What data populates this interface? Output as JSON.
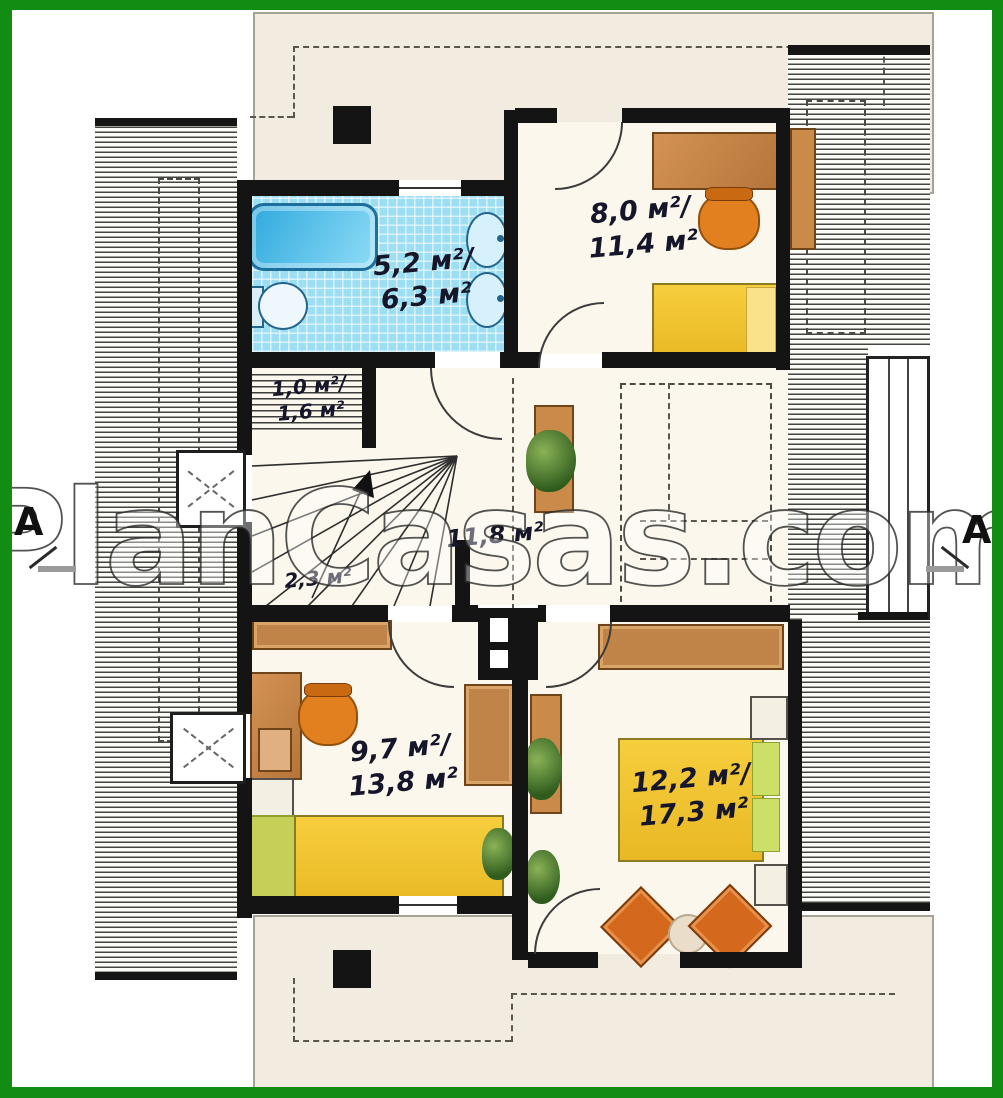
{
  "watermark": "PlanCasas.com",
  "markers": {
    "left": "A",
    "right": "A"
  },
  "colors": {
    "frame_green": "#128c12",
    "tile_blue": "#9edef3",
    "furniture_orange": "#d8822f",
    "bed_yellow": "#f2c230",
    "roof_cream": "#f1ecdf"
  },
  "rooms": {
    "bathroom": {
      "area_upper": "5,2 м²/",
      "area_total": "6,3 м²"
    },
    "bedroom_top_right": {
      "area_upper": "8,0 м²/",
      "area_total": "11,4 м²"
    },
    "closet": {
      "area_upper": "1,0 м²/",
      "area_total": "1,6 м²"
    },
    "stairs": {
      "area": "2,3 м²"
    },
    "hall": {
      "area": "11,8 м²"
    },
    "bedroom_bottom_left": {
      "area_upper": "9,7 м²/",
      "area_total": "13,8 м²"
    },
    "bedroom_bottom_right": {
      "area_upper": "12,2 м²/",
      "area_total": "17,3 м²"
    }
  }
}
